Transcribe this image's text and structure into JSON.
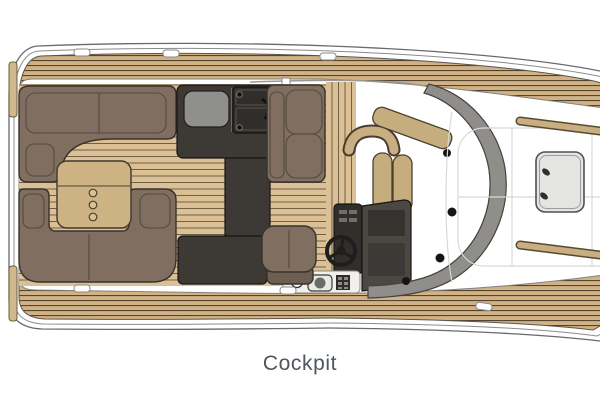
{
  "caption": {
    "text": "Cockpit"
  },
  "table": {
    "cupholders": 3
  },
  "components": [
    "aft-l-sofa",
    "aft-u-sofa",
    "cockpit-table",
    "wet-bar-galley",
    "grill",
    "sink",
    "forward-sofa",
    "boarding-steps",
    "companion-seat",
    "helm-seat",
    "steering-wheel",
    "helm-console",
    "controls-shelf",
    "windshield",
    "side-decks",
    "bow-sunpad",
    "bow-hatch",
    "grab-rails",
    "cleats"
  ],
  "colors": {
    "background": "#ffffff",
    "hull_line": "#6a6a6a",
    "deck_teak": "#d0b284",
    "deck_plank_line": "#53452f",
    "sole_teak": "#dcc095",
    "sole_plank_line": "#70604a",
    "sofa": "#806f61",
    "sofa_outline": "#38322b",
    "table": "#cdb383",
    "cupholder": "#d8c195",
    "charcoal": "#3d3a36",
    "grill": "#8f8f8d",
    "sink": "#302e2b",
    "console": "#4b4841",
    "console_screen": "#34332f",
    "console_column": "#302f2c",
    "windshield": "#908e8a",
    "bolt": "#151514",
    "seat_tan": "#c6ad7e",
    "hatch": "#e4e4e3",
    "rail_teak": "#c9ae81",
    "rail_outline": "#57492f",
    "shelf": "#f1f0ed",
    "label": "#4f565e"
  }
}
